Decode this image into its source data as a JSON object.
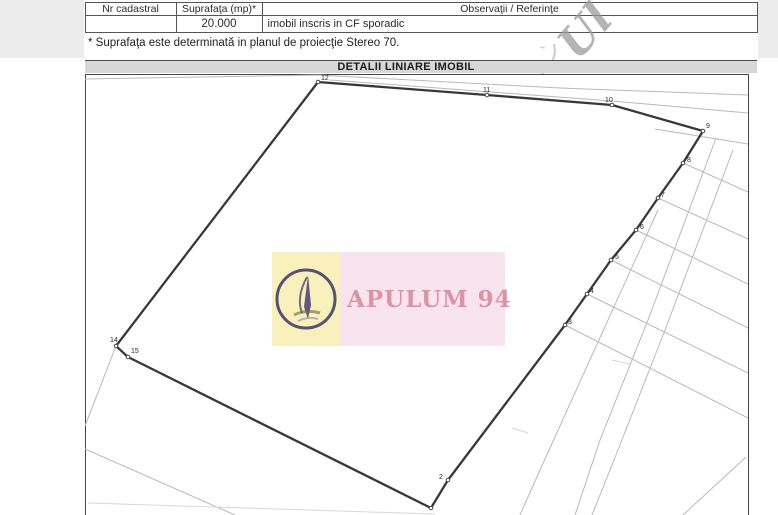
{
  "table": {
    "headers": [
      "Nr cadastral",
      "Suprafaţa (mp)*",
      "Observaţii / Referinţe"
    ],
    "row": {
      "nr_cadastral": "",
      "suprafata": "20.000",
      "observatii": "imobil inscris in CF sporadic"
    }
  },
  "note": "* Suprafaţa este determinată in planul de proiecţie Stereo 70.",
  "section_title": "DETALII LINIARE IMOBIL",
  "watermark": {
    "text": "APULUM 94"
  },
  "stamp": {
    "text": "Ul"
  },
  "map": {
    "colors": {
      "parcel": "#383838",
      "thin": "#b9b9b9",
      "faint": "#d8d8d8",
      "label": "#2a2a2a"
    },
    "parcel_outline": [
      [
        318,
        82
      ],
      [
        487,
        95
      ],
      [
        612,
        105
      ],
      [
        703,
        131
      ],
      [
        683,
        163
      ],
      [
        658,
        198
      ],
      [
        636,
        230
      ],
      [
        611,
        260
      ],
      [
        587,
        294
      ],
      [
        565,
        325
      ],
      [
        448,
        480
      ],
      [
        431,
        508
      ],
      [
        128,
        357
      ],
      [
        116,
        346
      ]
    ],
    "vertex_labels": [
      {
        "n": "12",
        "x": 321,
        "y": 80
      },
      {
        "n": "11",
        "x": 483,
        "y": 92
      },
      {
        "n": "10",
        "x": 605,
        "y": 102
      },
      {
        "n": "9",
        "x": 706,
        "y": 128
      },
      {
        "n": "8",
        "x": 687,
        "y": 162
      },
      {
        "n": "7",
        "x": 661,
        "y": 197
      },
      {
        "n": "6",
        "x": 640,
        "y": 229
      },
      {
        "n": "5",
        "x": 615,
        "y": 259
      },
      {
        "n": "4",
        "x": 590,
        "y": 293
      },
      {
        "n": "3",
        "x": 568,
        "y": 324
      },
      {
        "n": "2",
        "x": 439,
        "y": 479
      },
      {
        "n": "14",
        "x": 110,
        "y": 342
      },
      {
        "n": "15",
        "x": 131,
        "y": 353
      }
    ],
    "background_lines": [
      {
        "pts": [
          [
            85,
            79
          ],
          [
            318,
            75
          ],
          [
            560,
            88
          ],
          [
            748,
            95
          ]
        ],
        "w": "thin"
      },
      {
        "pts": [
          [
            330,
            80
          ],
          [
            612,
            101
          ],
          [
            748,
            113
          ]
        ],
        "w": "thin"
      },
      {
        "pts": [
          [
            655,
            129
          ],
          [
            748,
            144
          ]
        ],
        "w": "thin"
      },
      {
        "pts": [
          [
            683,
            163
          ],
          [
            748,
            192
          ]
        ],
        "w": "thin"
      },
      {
        "pts": [
          [
            658,
            198
          ],
          [
            748,
            239
          ]
        ],
        "w": "thin"
      },
      {
        "pts": [
          [
            636,
            230
          ],
          [
            748,
            284
          ]
        ],
        "w": "thin"
      },
      {
        "pts": [
          [
            611,
            260
          ],
          [
            748,
            328
          ]
        ],
        "w": "thin"
      },
      {
        "pts": [
          [
            587,
            294
          ],
          [
            748,
            373
          ]
        ],
        "w": "thin"
      },
      {
        "pts": [
          [
            565,
            325
          ],
          [
            748,
            418
          ]
        ],
        "w": "thin"
      },
      {
        "pts": [
          [
            658,
            210
          ],
          [
            593,
            353
          ],
          [
            540,
            470
          ],
          [
            520,
            515
          ]
        ],
        "w": "thin"
      },
      {
        "pts": [
          [
            716,
            138
          ],
          [
            648,
            320
          ],
          [
            600,
            440
          ],
          [
            575,
            515
          ]
        ],
        "w": "thin"
      },
      {
        "pts": [
          [
            733,
            150
          ],
          [
            665,
            330
          ],
          [
            618,
            450
          ],
          [
            592,
            515
          ]
        ],
        "w": "thin"
      },
      {
        "pts": [
          [
            746,
            457
          ],
          [
            683,
            515
          ]
        ],
        "w": "thin"
      },
      {
        "pts": [
          [
            116,
            346
          ],
          [
            85,
            426
          ]
        ],
        "w": "thin"
      },
      {
        "pts": [
          [
            85,
            449
          ],
          [
            235,
            515
          ]
        ],
        "w": "thin"
      },
      {
        "pts": [
          [
            88,
            503
          ],
          [
            435,
            514
          ]
        ],
        "w": "faint"
      },
      {
        "pts": [
          [
            612,
            360
          ],
          [
            630,
            364
          ]
        ],
        "w": "faint"
      },
      {
        "pts": [
          [
            512,
            428
          ],
          [
            528,
            433
          ]
        ],
        "w": "faint"
      }
    ]
  }
}
